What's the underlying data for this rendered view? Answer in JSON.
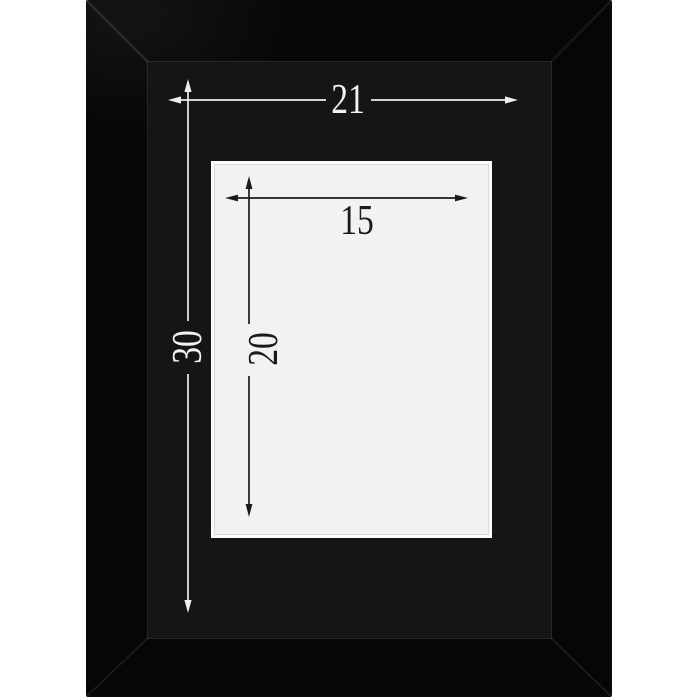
{
  "product_image": {
    "description": "black picture frame mat with white bevel opening, annotated with dimension arrows",
    "colors": {
      "page_background": "#ffffff",
      "frame_molding": "#060606",
      "mat_board": "#151515",
      "mat_edge_highlight": "#787878",
      "opening_rim": "#fcfcfc",
      "opening_fill": "#f2f2f2",
      "bevel_line": "#d9d9d9",
      "light_annotation": "#f2f2f2",
      "dark_annotation": "#1b1b1b"
    }
  },
  "dimensions": {
    "outer_width": {
      "label": "21",
      "orientation": "horizontal",
      "applies_to": "mat outer width",
      "annotation_color": "light"
    },
    "outer_height": {
      "label": "30",
      "orientation": "vertical",
      "applies_to": "mat outer height",
      "annotation_color": "light"
    },
    "opening_width": {
      "label": "15",
      "orientation": "horizontal",
      "applies_to": "opening width",
      "annotation_color": "dark"
    },
    "opening_height": {
      "label": "20",
      "orientation": "vertical",
      "applies_to": "opening height",
      "annotation_color": "dark"
    }
  }
}
